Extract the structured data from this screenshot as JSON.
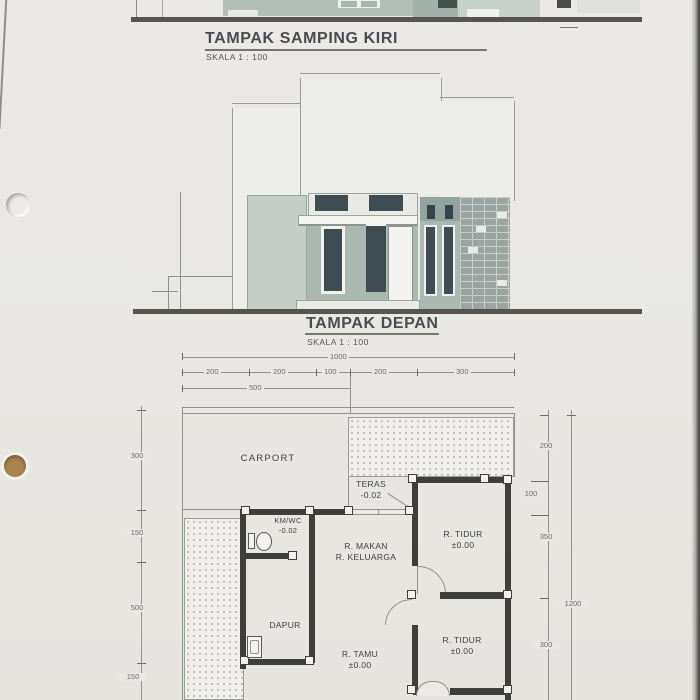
{
  "titles": {
    "side_view": {
      "title": "TAMPAK SAMPING KIRI",
      "scale": "SKALA  1 : 100"
    },
    "front_view": {
      "title": "TAMPAK DEPAN",
      "scale": "SKALA  1 : 100"
    }
  },
  "floor_plan": {
    "rooms": {
      "carport": {
        "name": "CARPORT"
      },
      "teras": {
        "name": "TERAS",
        "level": "-0.02"
      },
      "kmwc": {
        "name": "KM/WC",
        "level": "-0.02"
      },
      "r_makan": {
        "name": "R. MAKAN"
      },
      "r_keluarga": {
        "name": "R. KELUARGA"
      },
      "r_tidur_1": {
        "name": "R. TIDUR",
        "level": "±0.00"
      },
      "dapur": {
        "name": "DAPUR"
      },
      "r_tamu": {
        "name": "R. TAMU",
        "level": "±0.00"
      },
      "r_tidur_2": {
        "name": "R. TIDUR",
        "level": "±0.00"
      }
    },
    "dimensions": {
      "total_width": "1000",
      "top_segments": [
        "200",
        "200",
        "100",
        "200",
        "300"
      ],
      "top_sub_width": "500",
      "left_side": [
        "300",
        "150",
        "500",
        "150"
      ],
      "right_side": [
        "200",
        "100",
        "350",
        "300"
      ],
      "total_height_right": "1200"
    }
  },
  "colors": {
    "paper": "#e8e7e3",
    "wall_dark": "#3e3e3b",
    "sage_light": "#c4cec6",
    "sage_mid": "#aab8b1",
    "sage_dark": "#93a49e",
    "glass_dark": "#3f4d53",
    "brick": "#9aa5a1",
    "line": "#8f928d",
    "hole_brown": "#a6834f"
  }
}
